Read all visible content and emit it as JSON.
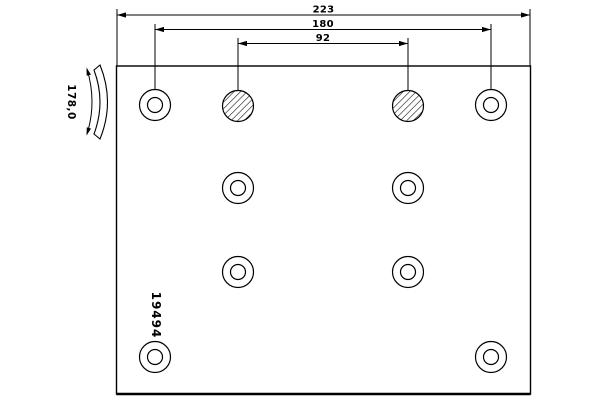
{
  "colors": {
    "background": "#ffffff",
    "line": "#000000"
  },
  "dimensions": {
    "total": {
      "label": "223"
    },
    "outer": {
      "label": "180"
    },
    "inner": {
      "label": "92"
    }
  },
  "curvature_radius_label": "178,0",
  "part_number": "19494",
  "holes": {
    "outer_radius": 15.5,
    "inner_radius": 7.5,
    "plain": [
      [
        155,
        105
      ],
      [
        491,
        105
      ],
      [
        238,
        188
      ],
      [
        408,
        188
      ],
      [
        238,
        272
      ],
      [
        408,
        272
      ],
      [
        155,
        357
      ],
      [
        491,
        357
      ]
    ],
    "hatched": [
      [
        238,
        106
      ],
      [
        408,
        106
      ]
    ]
  }
}
